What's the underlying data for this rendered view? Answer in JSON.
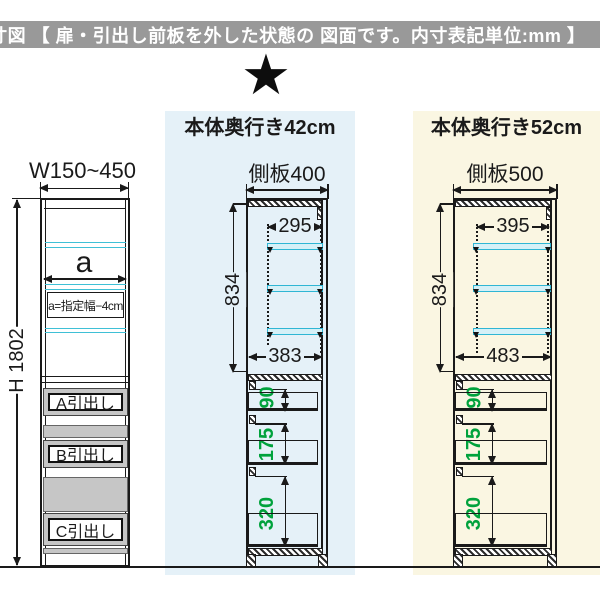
{
  "title_bar": {
    "text": "内寸図 【 扉・引出し前板を外した状態の 図面です。内寸表記単位:mm 】"
  },
  "star": {
    "glyph": "★"
  },
  "columns": {
    "depth42": {
      "header": "本体奥行き42cm"
    },
    "depth52": {
      "header": "本体奥行き52cm"
    }
  },
  "front_view": {
    "width_label": "W150~450",
    "height_label": "H 1802",
    "shelf_width_label": "a",
    "shelf_width_note": "a=指定幅−4cm",
    "drawers": [
      "A引出し",
      "B引出し",
      "C引出し"
    ]
  },
  "side_view_42": {
    "side_panel_label": "側板400",
    "inner_height": "834",
    "shelf_width": "295",
    "inner_width": "383",
    "drawer_depths": [
      "90",
      "175",
      "320"
    ]
  },
  "side_view_52": {
    "side_panel_label": "側板500",
    "inner_height": "834",
    "shelf_width": "395",
    "inner_width": "483",
    "drawer_depths": [
      "90",
      "175",
      "320"
    ]
  },
  "colors": {
    "band_blue": "#e5f1f8",
    "band_yellow": "#faf6e2",
    "shelf_cyan": "#2fb6d4",
    "dimension_green": "#00a23c",
    "title_bar_gray": "#999999",
    "drawer_gray": "#c6c6c6"
  }
}
